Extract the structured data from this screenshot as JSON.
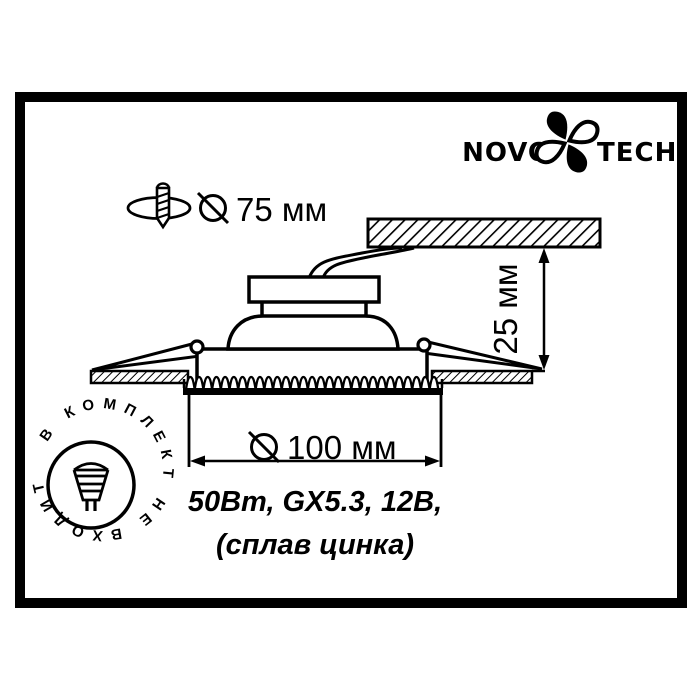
{
  "colors": {
    "ink": "#000000",
    "background": "#ffffff"
  },
  "logo": {
    "left": "NOVO",
    "right": "TECH"
  },
  "icons": {
    "logo_flower": "novotech-flower-icon",
    "drill": "drill-hole-icon",
    "diameter_sign": "⌀",
    "lamp": "mr16-lamp-icon"
  },
  "dimensions": {
    "cutout": {
      "symbol": "⌀",
      "value": "75 мм"
    },
    "depth": {
      "value": "25 мм"
    },
    "diameter": {
      "symbol": "⌀",
      "value": "100 мм"
    }
  },
  "specs": {
    "line1": "50Вт, GX5.3, 12В,",
    "line2": "(сплав цинка)"
  },
  "badge": {
    "text": "В КОМПЛЕКТ НЕ ВХОДИТ"
  }
}
